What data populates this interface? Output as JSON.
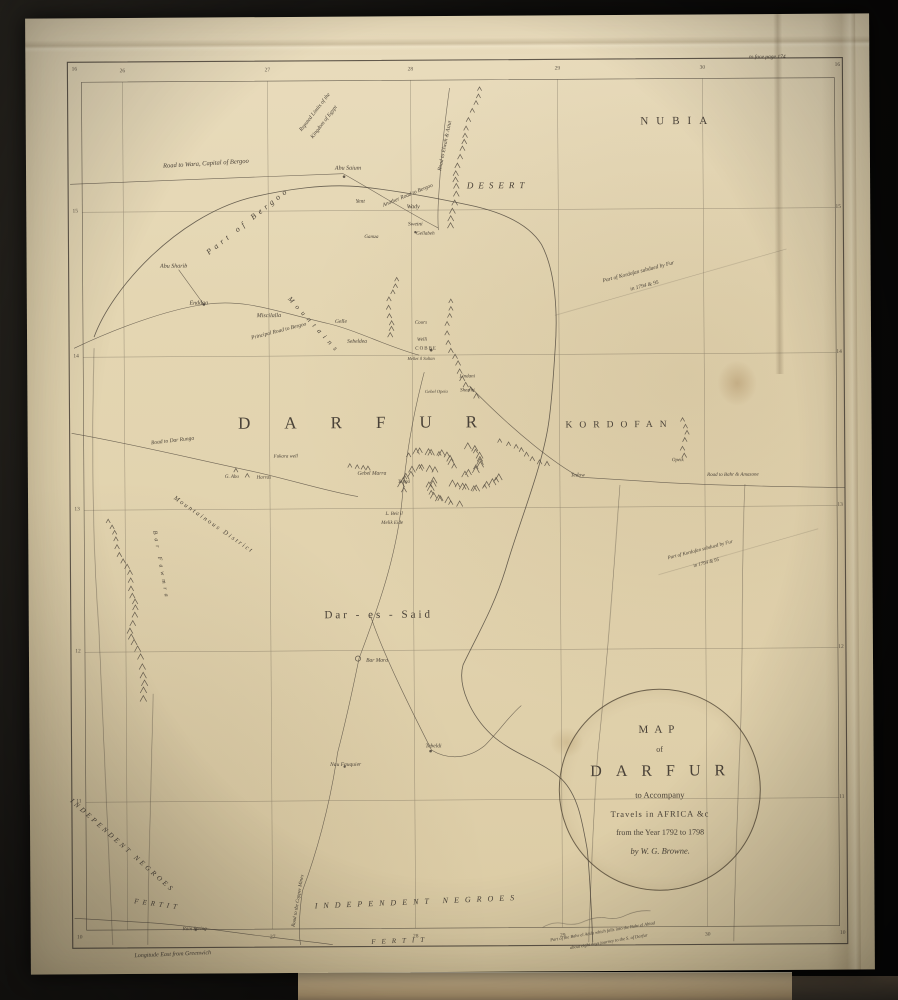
{
  "colors": {
    "ink": "#4a4238",
    "paper": "#e4d6b4",
    "background": "#0d0c0a",
    "book_edge": "#c9b28a"
  },
  "cartouche": {
    "line1": "MAP",
    "line2": "of",
    "line3": "DARFUR",
    "line4": "to Accompany",
    "line5": "Travels in AFRICA &c",
    "line6": "from the Year 1792 to 1798",
    "line7": "by W. G. Browne."
  },
  "labels": [
    {
      "t": "NUBIA",
      "x": 652,
      "y": 107,
      "s": 11,
      "ls": 8
    },
    {
      "t": "DESERT",
      "x": 472,
      "y": 170,
      "s": 9,
      "ls": 5,
      "cls": "caps-it"
    },
    {
      "t": "DARFUR",
      "x": 347,
      "y": 406,
      "s": 17,
      "ls": 34
    },
    {
      "t": "KORDOFAN",
      "x": 592,
      "y": 411,
      "s": 9.5,
      "ls": 7
    },
    {
      "t": "Dar - es - Said",
      "x": 350,
      "y": 599,
      "s": 11,
      "ls": 3
    },
    {
      "t": "Road to Wara, Capital of Bergoo",
      "x": 180,
      "y": 147,
      "s": 6.5,
      "r": -3,
      "cls": "it"
    },
    {
      "t": "Part of Bergoo",
      "x": 222,
      "y": 204,
      "s": 8,
      "r": -38,
      "ls": 4,
      "cls": "it"
    },
    {
      "t": "Abu Saium",
      "x": 322,
      "y": 152,
      "s": 6,
      "cls": "it"
    },
    {
      "t": "Another Road to Bergoo",
      "x": 382,
      "y": 180,
      "s": 5.5,
      "r": -22,
      "cls": "it"
    },
    {
      "t": "Yent",
      "x": 334,
      "y": 186,
      "s": 5.5,
      "cls": "it"
    },
    {
      "t": "Wady",
      "x": 387,
      "y": 191,
      "s": 6,
      "cls": "it"
    },
    {
      "t": "Reputed Limits of the",
      "x": 290,
      "y": 96,
      "s": 5.5,
      "r": -52,
      "cls": "it"
    },
    {
      "t": "Kingdom of Egypt",
      "x": 299,
      "y": 106,
      "s": 5.5,
      "r": -52,
      "cls": "it"
    },
    {
      "t": "Road to Elwah & Asiut",
      "x": 420,
      "y": 130,
      "s": 5.5,
      "r": -78,
      "cls": "it"
    },
    {
      "t": "Part of Kordofan subdued by Fur",
      "x": 612,
      "y": 258,
      "s": 5.5,
      "r": -14,
      "cls": "it"
    },
    {
      "t": "in 1794 & 95",
      "x": 618,
      "y": 272,
      "s": 5.5,
      "r": -14,
      "cls": "it"
    },
    {
      "t": "Abu Sharib",
      "x": 147,
      "y": 249,
      "s": 6,
      "cls": "it"
    },
    {
      "t": "Enddaa",
      "x": 172,
      "y": 286,
      "s": 6,
      "cls": "it"
    },
    {
      "t": "Miscilalla",
      "x": 242,
      "y": 299,
      "s": 6,
      "cls": "it"
    },
    {
      "t": "Principal Road to Bergoo",
      "x": 252,
      "y": 315,
      "s": 5.5,
      "r": -14,
      "cls": "it"
    },
    {
      "t": "Mountains",
      "x": 287,
      "y": 309,
      "s": 7,
      "r": 48,
      "ls": 5,
      "cls": "it"
    },
    {
      "t": "Gelle",
      "x": 314,
      "y": 306,
      "s": 5.5,
      "cls": "it"
    },
    {
      "t": "Sebeldea",
      "x": 330,
      "y": 326,
      "s": 5.5,
      "cls": "it"
    },
    {
      "t": "Sweini",
      "x": 389,
      "y": 209,
      "s": 5.5,
      "cls": "it"
    },
    {
      "t": "Gellabeh",
      "x": 399,
      "y": 218,
      "s": 5,
      "cls": "it"
    },
    {
      "t": "Gamza",
      "x": 345,
      "y": 221,
      "s": 5,
      "cls": "it"
    },
    {
      "t": "Cours",
      "x": 394,
      "y": 307,
      "s": 5,
      "cls": "it"
    },
    {
      "t": "Welli",
      "x": 395,
      "y": 324,
      "s": 5,
      "cls": "it"
    },
    {
      "t": "COBBE",
      "x": 399,
      "y": 333,
      "s": 5,
      "ls": 1
    },
    {
      "t": "Hellet il Sultan",
      "x": 394,
      "y": 343,
      "s": 4.5,
      "cls": "it"
    },
    {
      "t": "Lindani",
      "x": 440,
      "y": 361,
      "s": 5,
      "cls": "it"
    },
    {
      "t": "Gebel Opeia",
      "x": 409,
      "y": 376,
      "s": 4.5,
      "cls": "it"
    },
    {
      "t": "Sherini",
      "x": 440,
      "y": 375,
      "s": 5,
      "cls": "it"
    },
    {
      "t": "Road to Dar Runga",
      "x": 145,
      "y": 424,
      "s": 5.5,
      "r": -6,
      "cls": "it"
    },
    {
      "t": "Fukara well",
      "x": 258,
      "y": 440,
      "s": 5,
      "cls": "it"
    },
    {
      "t": "G. Abu",
      "x": 204,
      "y": 460,
      "s": 5,
      "cls": "it"
    },
    {
      "t": "Harras",
      "x": 236,
      "y": 461,
      "s": 5,
      "cls": "it"
    },
    {
      "t": "Gebel Marra",
      "x": 344,
      "y": 458,
      "s": 5.5,
      "cls": "it"
    },
    {
      "t": "Tenga",
      "x": 376,
      "y": 466,
      "s": 5,
      "cls": "it"
    },
    {
      "t": "Tedow",
      "x": 550,
      "y": 461,
      "s": 5.5,
      "cls": "it"
    },
    {
      "t": "Opeik",
      "x": 650,
      "y": 446,
      "s": 5,
      "cls": "it"
    },
    {
      "t": "Road to Bahr & Amazone",
      "x": 705,
      "y": 461,
      "s": 5,
      "cls": "it"
    },
    {
      "t": "L. Beit il",
      "x": 366,
      "y": 498,
      "s": 5,
      "cls": "it"
    },
    {
      "t": "Melik Eide",
      "x": 364,
      "y": 507,
      "s": 5,
      "cls": "it"
    },
    {
      "t": "Mountainous District",
      "x": 185,
      "y": 508,
      "s": 6.5,
      "r": 35,
      "ls": 2,
      "cls": "it"
    },
    {
      "t": "Part of Kordofan subdued by Fur",
      "x": 672,
      "y": 536,
      "s": 5,
      "r": -14,
      "cls": "it"
    },
    {
      "t": "in 1794 & 95",
      "x": 678,
      "y": 549,
      "s": 5,
      "r": -14,
      "cls": "it"
    },
    {
      "t": "Bar Fawmra",
      "x": 132,
      "y": 548,
      "s": 6,
      "r": 80,
      "ls": 4,
      "cls": "it"
    },
    {
      "t": "Bar Mara",
      "x": 348,
      "y": 645,
      "s": 5.5,
      "cls": "it"
    },
    {
      "t": "Tebeldi",
      "x": 404,
      "y": 731,
      "s": 5.5,
      "cls": "it"
    },
    {
      "t": "Nau Fauquier",
      "x": 316,
      "y": 749,
      "s": 5.5,
      "cls": "it"
    },
    {
      "t": "INDEPENDENT NEGROES",
      "x": 92,
      "y": 828,
      "s": 7,
      "r": 42,
      "ls": 3,
      "cls": "caps-it"
    },
    {
      "t": "FERTIT",
      "x": 127,
      "y": 887,
      "s": 7,
      "r": 8,
      "ls": 4,
      "cls": "caps-it"
    },
    {
      "t": "Rain Spring",
      "x": 164,
      "y": 912,
      "s": 5,
      "cls": "it"
    },
    {
      "t": "Road to the Copper Mines",
      "x": 268,
      "y": 884,
      "s": 5,
      "r": -80,
      "cls": "it"
    },
    {
      "t": "INDEPENDENT NEGROES",
      "x": 387,
      "y": 886,
      "s": 8,
      "r": -2,
      "ls": 6,
      "cls": "caps-it"
    },
    {
      "t": "FERTIT",
      "x": 370,
      "y": 925,
      "s": 7,
      "r": -2,
      "ls": 6,
      "cls": "caps-it"
    },
    {
      "t": "Part of the Bahr el Adda which falls into the Bahr el Abiad",
      "x": 572,
      "y": 917,
      "s": 4.5,
      "r": -9,
      "cls": "it"
    },
    {
      "t": "about eight days journey to the S. of Darfur",
      "x": 578,
      "y": 927,
      "s": 4.5,
      "r": -9,
      "cls": "it"
    },
    {
      "t": "Longitude East from Greenwich",
      "x": 142,
      "y": 937,
      "s": 6,
      "r": -2,
      "cls": "it"
    },
    {
      "t": "to face page 174",
      "x": 742,
      "y": 44,
      "s": 5.5,
      "cls": "it"
    },
    {
      "t": "16",
      "x": 49,
      "y": 52,
      "cls": "tick"
    },
    {
      "t": "15",
      "x": 49,
      "y": 194,
      "cls": "tick"
    },
    {
      "t": "14",
      "x": 49,
      "y": 339,
      "cls": "tick"
    },
    {
      "t": "13",
      "x": 49,
      "y": 492,
      "cls": "tick"
    },
    {
      "t": "12",
      "x": 49,
      "y": 634,
      "cls": "tick"
    },
    {
      "t": "11",
      "x": 49,
      "y": 784,
      "cls": "tick"
    },
    {
      "t": "10",
      "x": 49,
      "y": 920,
      "cls": "tick"
    },
    {
      "t": "16",
      "x": 812,
      "y": 52,
      "cls": "tick"
    },
    {
      "t": "15",
      "x": 812,
      "y": 194,
      "cls": "tick"
    },
    {
      "t": "14",
      "x": 812,
      "y": 339,
      "cls": "tick"
    },
    {
      "t": "13",
      "x": 812,
      "y": 492,
      "cls": "tick"
    },
    {
      "t": "12",
      "x": 812,
      "y": 634,
      "cls": "tick"
    },
    {
      "t": "11",
      "x": 812,
      "y": 784,
      "cls": "tick"
    },
    {
      "t": "10",
      "x": 812,
      "y": 920,
      "cls": "tick"
    },
    {
      "t": "26",
      "x": 97,
      "y": 54,
      "cls": "tick"
    },
    {
      "t": "27",
      "x": 242,
      "y": 54,
      "cls": "tick"
    },
    {
      "t": "28",
      "x": 385,
      "y": 54,
      "cls": "tick"
    },
    {
      "t": "29",
      "x": 532,
      "y": 54,
      "cls": "tick"
    },
    {
      "t": "30",
      "x": 677,
      "y": 54,
      "cls": "tick"
    },
    {
      "t": "27",
      "x": 242,
      "y": 921,
      "cls": "tick"
    },
    {
      "t": "28",
      "x": 385,
      "y": 921,
      "cls": "tick"
    },
    {
      "t": "29",
      "x": 532,
      "y": 921,
      "cls": "tick"
    },
    {
      "t": "30",
      "x": 677,
      "y": 921,
      "cls": "tick"
    }
  ]
}
